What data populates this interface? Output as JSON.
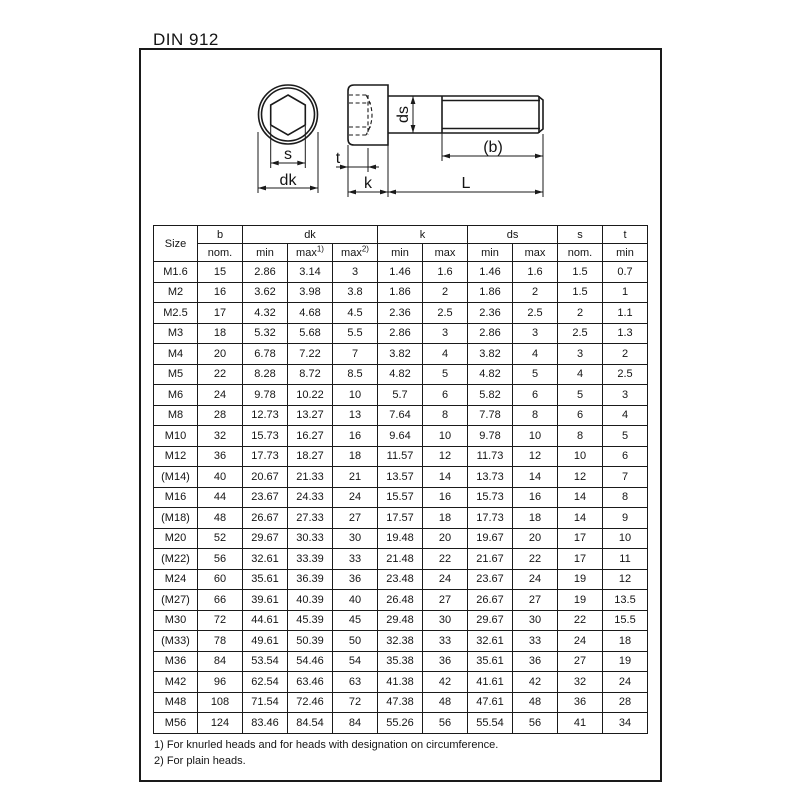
{
  "title": "DIN 912",
  "drawing": {
    "labels": {
      "s": "s",
      "dk": "dk",
      "t": "t",
      "k": "k",
      "ds": "ds",
      "b": "(b)",
      "L": "L"
    }
  },
  "table": {
    "header": {
      "size": "Size",
      "b": "b",
      "dk": "dk",
      "k": "k",
      "ds": "ds",
      "s": "s",
      "t": "t"
    },
    "subheader": {
      "b_nom": "nom.",
      "dk_min": "min",
      "dk_max1": "max",
      "dk_max1_sup": "1)",
      "dk_max2": "max",
      "dk_max2_sup": "2)",
      "k_min": "min",
      "k_max": "max",
      "ds_min": "min",
      "ds_max": "max",
      "s_nom": "nom.",
      "t_min": "min"
    },
    "rows": [
      [
        "M1.6",
        "15",
        "2.86",
        "3.14",
        "3",
        "1.46",
        "1.6",
        "1.46",
        "1.6",
        "1.5",
        "0.7"
      ],
      [
        "M2",
        "16",
        "3.62",
        "3.98",
        "3.8",
        "1.86",
        "2",
        "1.86",
        "2",
        "1.5",
        "1"
      ],
      [
        "M2.5",
        "17",
        "4.32",
        "4.68",
        "4.5",
        "2.36",
        "2.5",
        "2.36",
        "2.5",
        "2",
        "1.1"
      ],
      [
        "M3",
        "18",
        "5.32",
        "5.68",
        "5.5",
        "2.86",
        "3",
        "2.86",
        "3",
        "2.5",
        "1.3"
      ],
      [
        "M4",
        "20",
        "6.78",
        "7.22",
        "7",
        "3.82",
        "4",
        "3.82",
        "4",
        "3",
        "2"
      ],
      [
        "M5",
        "22",
        "8.28",
        "8.72",
        "8.5",
        "4.82",
        "5",
        "4.82",
        "5",
        "4",
        "2.5"
      ],
      [
        "M6",
        "24",
        "9.78",
        "10.22",
        "10",
        "5.7",
        "6",
        "5.82",
        "6",
        "5",
        "3"
      ],
      [
        "M8",
        "28",
        "12.73",
        "13.27",
        "13",
        "7.64",
        "8",
        "7.78",
        "8",
        "6",
        "4"
      ],
      [
        "M10",
        "32",
        "15.73",
        "16.27",
        "16",
        "9.64",
        "10",
        "9.78",
        "10",
        "8",
        "5"
      ],
      [
        "M12",
        "36",
        "17.73",
        "18.27",
        "18",
        "11.57",
        "12",
        "11.73",
        "12",
        "10",
        "6"
      ],
      [
        "(M14)",
        "40",
        "20.67",
        "21.33",
        "21",
        "13.57",
        "14",
        "13.73",
        "14",
        "12",
        "7"
      ],
      [
        "M16",
        "44",
        "23.67",
        "24.33",
        "24",
        "15.57",
        "16",
        "15.73",
        "16",
        "14",
        "8"
      ],
      [
        "(M18)",
        "48",
        "26.67",
        "27.33",
        "27",
        "17.57",
        "18",
        "17.73",
        "18",
        "14",
        "9"
      ],
      [
        "M20",
        "52",
        "29.67",
        "30.33",
        "30",
        "19.48",
        "20",
        "19.67",
        "20",
        "17",
        "10"
      ],
      [
        "(M22)",
        "56",
        "32.61",
        "33.39",
        "33",
        "21.48",
        "22",
        "21.67",
        "22",
        "17",
        "11"
      ],
      [
        "M24",
        "60",
        "35.61",
        "36.39",
        "36",
        "23.48",
        "24",
        "23.67",
        "24",
        "19",
        "12"
      ],
      [
        "(M27)",
        "66",
        "39.61",
        "40.39",
        "40",
        "26.48",
        "27",
        "26.67",
        "27",
        "19",
        "13.5"
      ],
      [
        "M30",
        "72",
        "44.61",
        "45.39",
        "45",
        "29.48",
        "30",
        "29.67",
        "30",
        "22",
        "15.5"
      ],
      [
        "(M33)",
        "78",
        "49.61",
        "50.39",
        "50",
        "32.38",
        "33",
        "32.61",
        "33",
        "24",
        "18"
      ],
      [
        "M36",
        "84",
        "53.54",
        "54.46",
        "54",
        "35.38",
        "36",
        "35.61",
        "36",
        "27",
        "19"
      ],
      [
        "M42",
        "96",
        "62.54",
        "63.46",
        "63",
        "41.38",
        "42",
        "41.61",
        "42",
        "32",
        "24"
      ],
      [
        "M48",
        "108",
        "71.54",
        "72.46",
        "72",
        "47.38",
        "48",
        "47.61",
        "48",
        "36",
        "28"
      ],
      [
        "M56",
        "124",
        "83.46",
        "84.54",
        "84",
        "55.26",
        "56",
        "55.54",
        "56",
        "41",
        "34"
      ]
    ]
  },
  "footnotes": [
    "1) For knurled heads and for heads with designation on circumference.",
    "2) For plain heads."
  ]
}
